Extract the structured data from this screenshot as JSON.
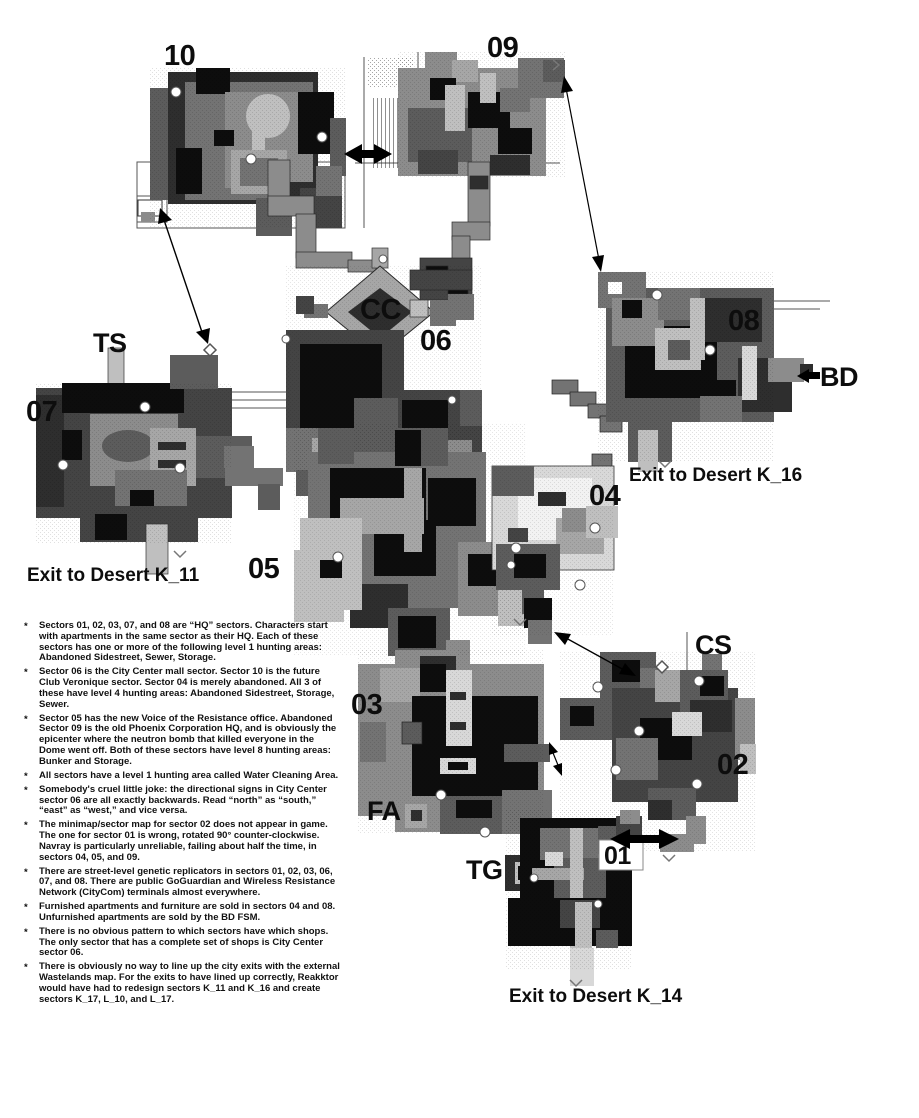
{
  "map": {
    "sector_labels": {
      "s10": "10",
      "s09": "09",
      "s08": "08",
      "s07": "07",
      "s06": "06",
      "s05": "05",
      "s04": "04",
      "s03": "03",
      "s02": "02",
      "s01": "01"
    },
    "area_labels": {
      "cc": "CC",
      "ts": "TS",
      "bd": "BD",
      "cs": "CS",
      "fa": "FA",
      "tg": "TG"
    },
    "exit_labels": {
      "k11": "Exit to Desert K_11",
      "k16": "Exit to Desert K_16",
      "k14": "Exit to Desert K_14"
    }
  },
  "notes": {
    "bullet": "*",
    "items": [
      "Sectors 01, 02, 03, 07, and 08 are “HQ” sectors. Characters start with apartments in the same sector as their HQ. Each of these sectors has one or more of the following level 1 hunting areas: Abandoned Sidestreet, Sewer, Storage.",
      "Sector 06 is the City Center mall sector. Sector 10 is the future Club Veronique sector. Sector 04 is merely abandoned. All 3 of these have level 4 hunting areas: Abandoned Sidestreet, Storage, Sewer.",
      "Sector 05 has the new Voice of the Resistance office. Abandoned Sector 09 is the old Phoenix Corporation HQ, and is obviously the epicenter where the neutron bomb that killed everyone in the Dome went off. Both of these sectors have level 8 hunting areas: Bunker and Storage.",
      "All sectors have a level 1 hunting area called Water Cleaning Area.",
      "Somebody's cruel little joke: the directional signs in City Center sector 06 are all exactly backwards. Read “north” as “south,” “east” as “west,” and vice versa.",
      "The minimap/sector map for sector 02 does not appear in game. The one for sector 01 is wrong, rotated 90° counter-clockwise. Navray is particularly unreliable, failing about half the time, in sectors 04, 05, and 09.",
      "There are street-level genetic replicators in sectors 01, 02, 03, 06, 07, and 08. There are public GoGuardian and Wireless Resistance Network (CityCom) terminals almost everywhere.",
      "Furnished apartments and furniture are sold in sectors 04 and 08.  Unfurnished apartments are sold by the BD FSM.",
      "There is no obvious pattern to which sectors have which shops. The only sector that has a complete set of shops is City Center sector 06.",
      "There is obviously no way to line up the city exits with the external Wastelands map. For the exits to have lined up correctly, Reakktor would have had to redesign sectors K_11 and K_16  and create sectors K_17, L_10, and L_17."
    ]
  },
  "colors": {
    "ink": "#0d0d0d",
    "map_black": "#0d0d0d",
    "map_dark": "#444444",
    "map_mid": "#737373",
    "map_light": "#bfbfbf",
    "map_lighter": "#d8d8d8"
  }
}
